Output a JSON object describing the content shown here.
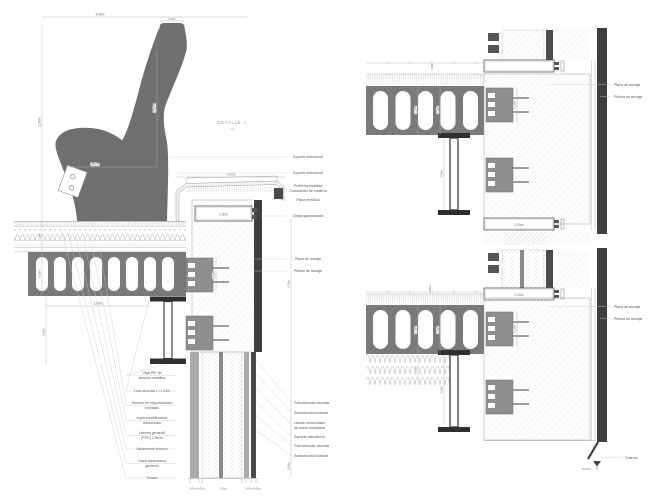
{
  "detail_a": {
    "title": "DETALLE A",
    "scale": "1:4",
    "dims": {
      "total_width": "5,43m",
      "seat_cap": "0,33m",
      "back_height": "0,60m",
      "seat_depth": "0,40m",
      "total_height": "1,30m",
      "roof_layers": "0,10m",
      "slab_thickness": "0,30m",
      "slab_span": "1,00m",
      "beam_depth": "0,50m",
      "parapet_width": "0,50m",
      "ring_beam_width": "0,30m",
      "anchor_plate": "0,15m",
      "wall_upper": "0,70m",
      "wall_lower": "0,65m",
      "base_group_left": "0,03m 0,02m",
      "base_group_mid": "0,15m",
      "base_group_right": "0,02m 0,03m"
    },
    "labels_right": [
      "Soporte estructural",
      "Soporte estructural",
      "Perfilería metálica",
      "Coronación de cubierta",
      "Placa metálica",
      "Chapa galvanizada",
      "Placa de anclaje",
      "Pletina de anclaje"
    ],
    "labels_left": [
      "Viga IPE de",
      "sección metálica",
      "Losa alveolar L=1,20m",
      "Mortero de regularización",
      "nivelado",
      "Impermeabilización",
      "bituminosa",
      "Lámina geotextil",
      "(PVC) 1,5mm",
      "Aislamiento térmico",
      "Capa separadora",
      "geotextil",
      "Solado"
    ],
    "labels_lower_right": [
      "Policarbonato alveolar",
      "Subestructura tubular",
      "Lamas horizontales",
      "de acero inoxidable",
      "Soporte estructural",
      "Policarbonato alveolar",
      "Subestructura tubular"
    ]
  },
  "detail_b": {
    "labels": [
      "Placa de anclaje",
      "Pletina de anclaje"
    ],
    "dims": {
      "slab": "0,30m",
      "slab_inner": "0,25m",
      "beam": "0,50m",
      "anchor": "0,15m",
      "ring_beam": "0,30m",
      "layers": "0,05m"
    }
  },
  "detail_c": {
    "labels": [
      "Placa de anclaje",
      "Pletina de anclaje",
      "Goterón"
    ],
    "dims": {
      "ring_beam": "0,30m",
      "slab": "0,30m",
      "slab_inner": "0,25m",
      "insulation": "0,60m",
      "beam": "0,50m",
      "anchor": "0,15m",
      "layers": "0,05m",
      "level": "±0,00m"
    }
  },
  "colors": {
    "ink": "#3f3f3f",
    "concrete": "#777777",
    "anchor_plate": "#8f8f8f",
    "dimension": "#b3b3b3"
  }
}
